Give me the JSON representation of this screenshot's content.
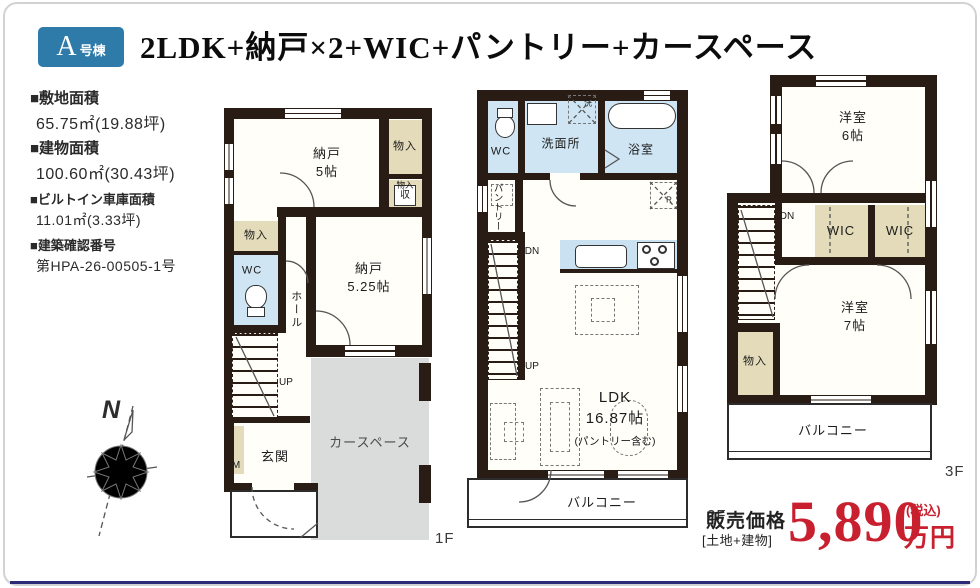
{
  "badge": {
    "unit": "A",
    "suffix": "号棟"
  },
  "title": "2LDK+納戸×2+WIC+パントリー+カースペース",
  "info": {
    "items": [
      {
        "label": "■敷地面積",
        "value": "65.75㎡(19.88坪)"
      },
      {
        "label": "■建物面積",
        "value": "100.60㎡(30.43坪)"
      },
      {
        "label": "■ビルトイン車庫面積",
        "value": "11.01㎡(3.33坪)"
      },
      {
        "label": "■建築確認番号",
        "value": "第HPA-26-00505-1号"
      }
    ]
  },
  "compass": {
    "north": "N"
  },
  "f1": {
    "floor_label": "1F",
    "nando5": "納戸\n5帖",
    "monoire_top": "物入",
    "monoire_mid": "物入",
    "shu": "収",
    "monoire_left": "物入",
    "wc": "WC",
    "nando525": "納戸\n5.25帖",
    "hall": "ホール",
    "up": "UP",
    "meter": "M",
    "genkan": "玄関",
    "carspace": "カースペース"
  },
  "f2": {
    "floor_label": "2F",
    "wc": "WC",
    "senmenjo": "洗面所",
    "yokushitsu": "浴室",
    "washer": "洗",
    "pantry": "パントリー",
    "dn": "DN",
    "up": "UP",
    "fridge": "R",
    "ldk": "LDK\n16.87帖",
    "ldk_note": "(パントリー含む)",
    "balcony": "バルコニー"
  },
  "f3": {
    "floor_label": "3F",
    "yoshitsu6": "洋室\n6帖",
    "dn": "DN",
    "wic1": "WIC",
    "wic2": "WIC",
    "monoire": "物入",
    "yoshitsu7": "洋室\n7帖",
    "balcony": "バルコニー"
  },
  "price": {
    "label": "販売価格",
    "sublabel": "[土地+建物]",
    "amount": "5,890",
    "tax": "(税込)",
    "unit": "万円"
  }
}
